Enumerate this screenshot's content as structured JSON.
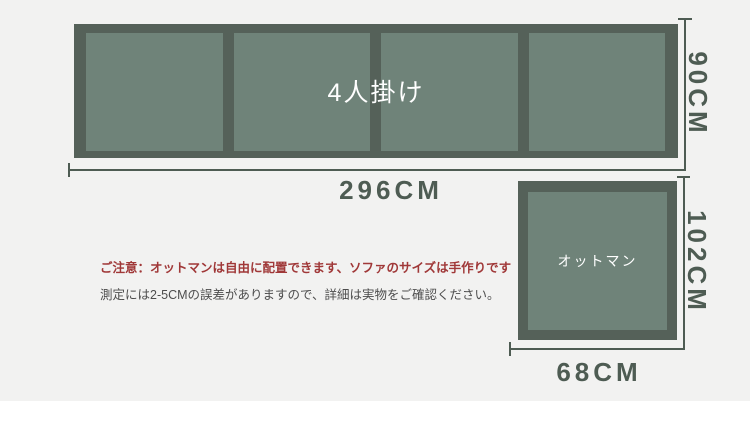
{
  "page": {
    "background_color": "#f2f2f1",
    "footer_color": "#ffffff"
  },
  "diagram": {
    "dimension_color": "#4e5c53",
    "sofa": {
      "label": "4人掛け",
      "seat_count": 4,
      "width_label": "296CM",
      "height_label": "90CM",
      "frame_color": "#556159",
      "cushion_color": "#6f8379",
      "label_color": "#ffffff"
    },
    "ottoman": {
      "label": "オットマン",
      "width_label": "68CM",
      "height_label": "102CM",
      "frame_color": "#556159",
      "cushion_color": "#6f8379",
      "label_color": "#ffffff"
    }
  },
  "notes": {
    "warning": "ご注意：オットマンは自由に配置できます、ソファのサイズは手作りです",
    "warning_color": "#a03838",
    "disclaimer": "測定には2-5CMの誤差がありますので、詳細は実物をご確認ください。",
    "disclaimer_color": "#4d4d4d"
  }
}
